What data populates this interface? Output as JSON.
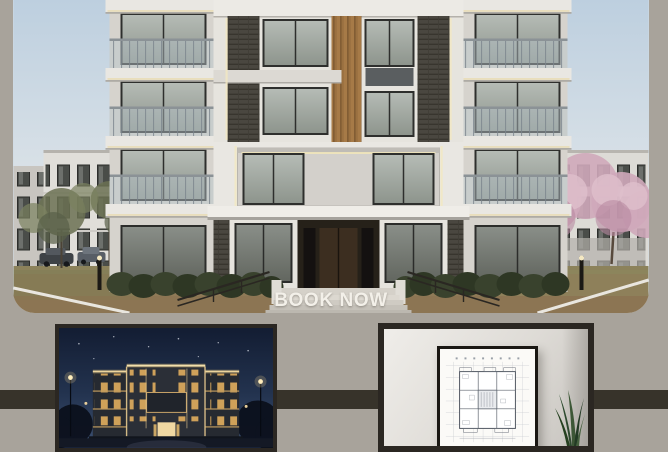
{
  "hero": {
    "cta_label": "BOOK NOW"
  },
  "colors": {
    "page_background": "#a8a39b",
    "accent_band": "#37332a",
    "panel_frame": "#2b2722",
    "cta_text": "#f3f0e9",
    "day_sky": "#bdcfdf",
    "night_sky": "#131d33",
    "lit_window": "#d8a75c",
    "wood_accent": "#a67a47",
    "blossom_pink": "#cfa9ba",
    "facade_white": "#e6e4de",
    "slate_dark": "#4a4740",
    "dirt_ground": "#8f7a57"
  }
}
